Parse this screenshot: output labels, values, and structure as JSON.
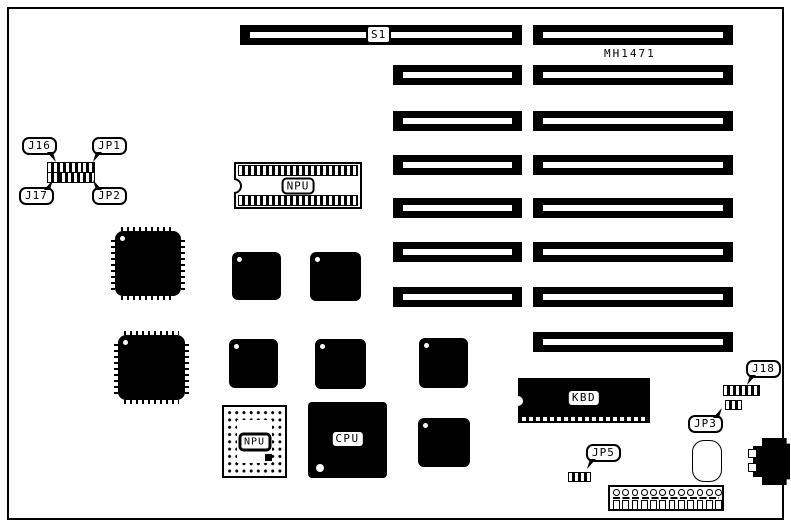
{
  "diagram": {
    "type": "motherboard-layout",
    "board_model": "MH1471",
    "colors": {
      "ink": "#000000",
      "background": "#ffffff"
    },
    "slots": {
      "s1_label": "S1"
    },
    "callouts": {
      "j16": "J16",
      "jp1": "JP1",
      "j17": "J17",
      "jp2": "JP2",
      "j18": "J18",
      "jp3": "JP3",
      "jp5": "JP5"
    },
    "chips": {
      "npu_dip": "NPU",
      "npu_pga": "NPU",
      "cpu": "CPU",
      "kbd": "KBD"
    }
  }
}
